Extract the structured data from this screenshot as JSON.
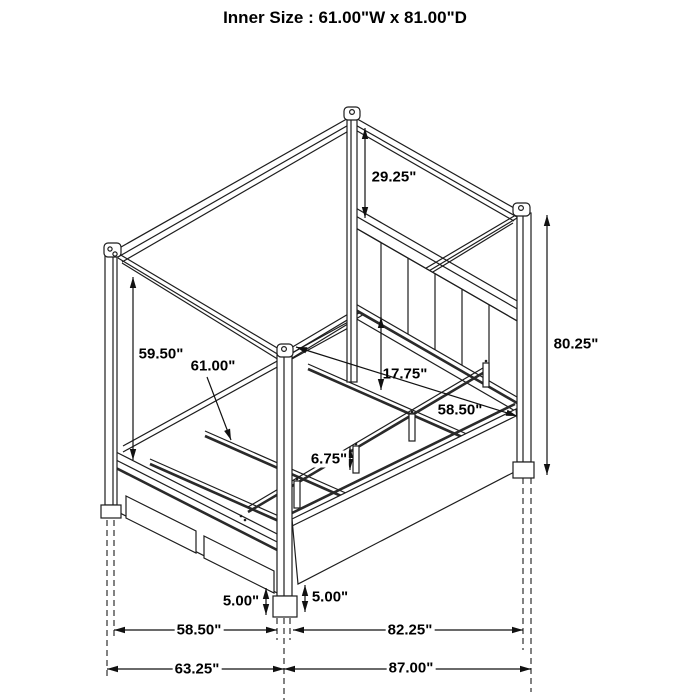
{
  "title": "Inner Size : 61.00\"W x 81.00\"D",
  "diagram": {
    "type": "furniture-dimension-diagram",
    "subject": "four-poster canopy storage bed with footboard drawers, slat deck and upholstered channel headboard",
    "line_color": "#1d1d1d",
    "background": "#ffffff",
    "dimensions": {
      "inner_width": "61.00\"W",
      "inner_depth": "81.00\"D",
      "canopy_to_headboard": "29.25\"",
      "overall_height": "80.25\"",
      "canopy_clearance": "59.50\"",
      "slat_width": "61.00\"",
      "headboard_panel_height": "17.75\"",
      "side_rail_length": "58.50\"",
      "support_leg_height": "6.75\"",
      "footboard_base_height": "5.00\"",
      "rail_base_height": "5.00\"",
      "footboard_width": "58.50\"",
      "side_span": "82.25\"",
      "overall_width": "63.25\"",
      "overall_depth": "87.00\""
    }
  }
}
